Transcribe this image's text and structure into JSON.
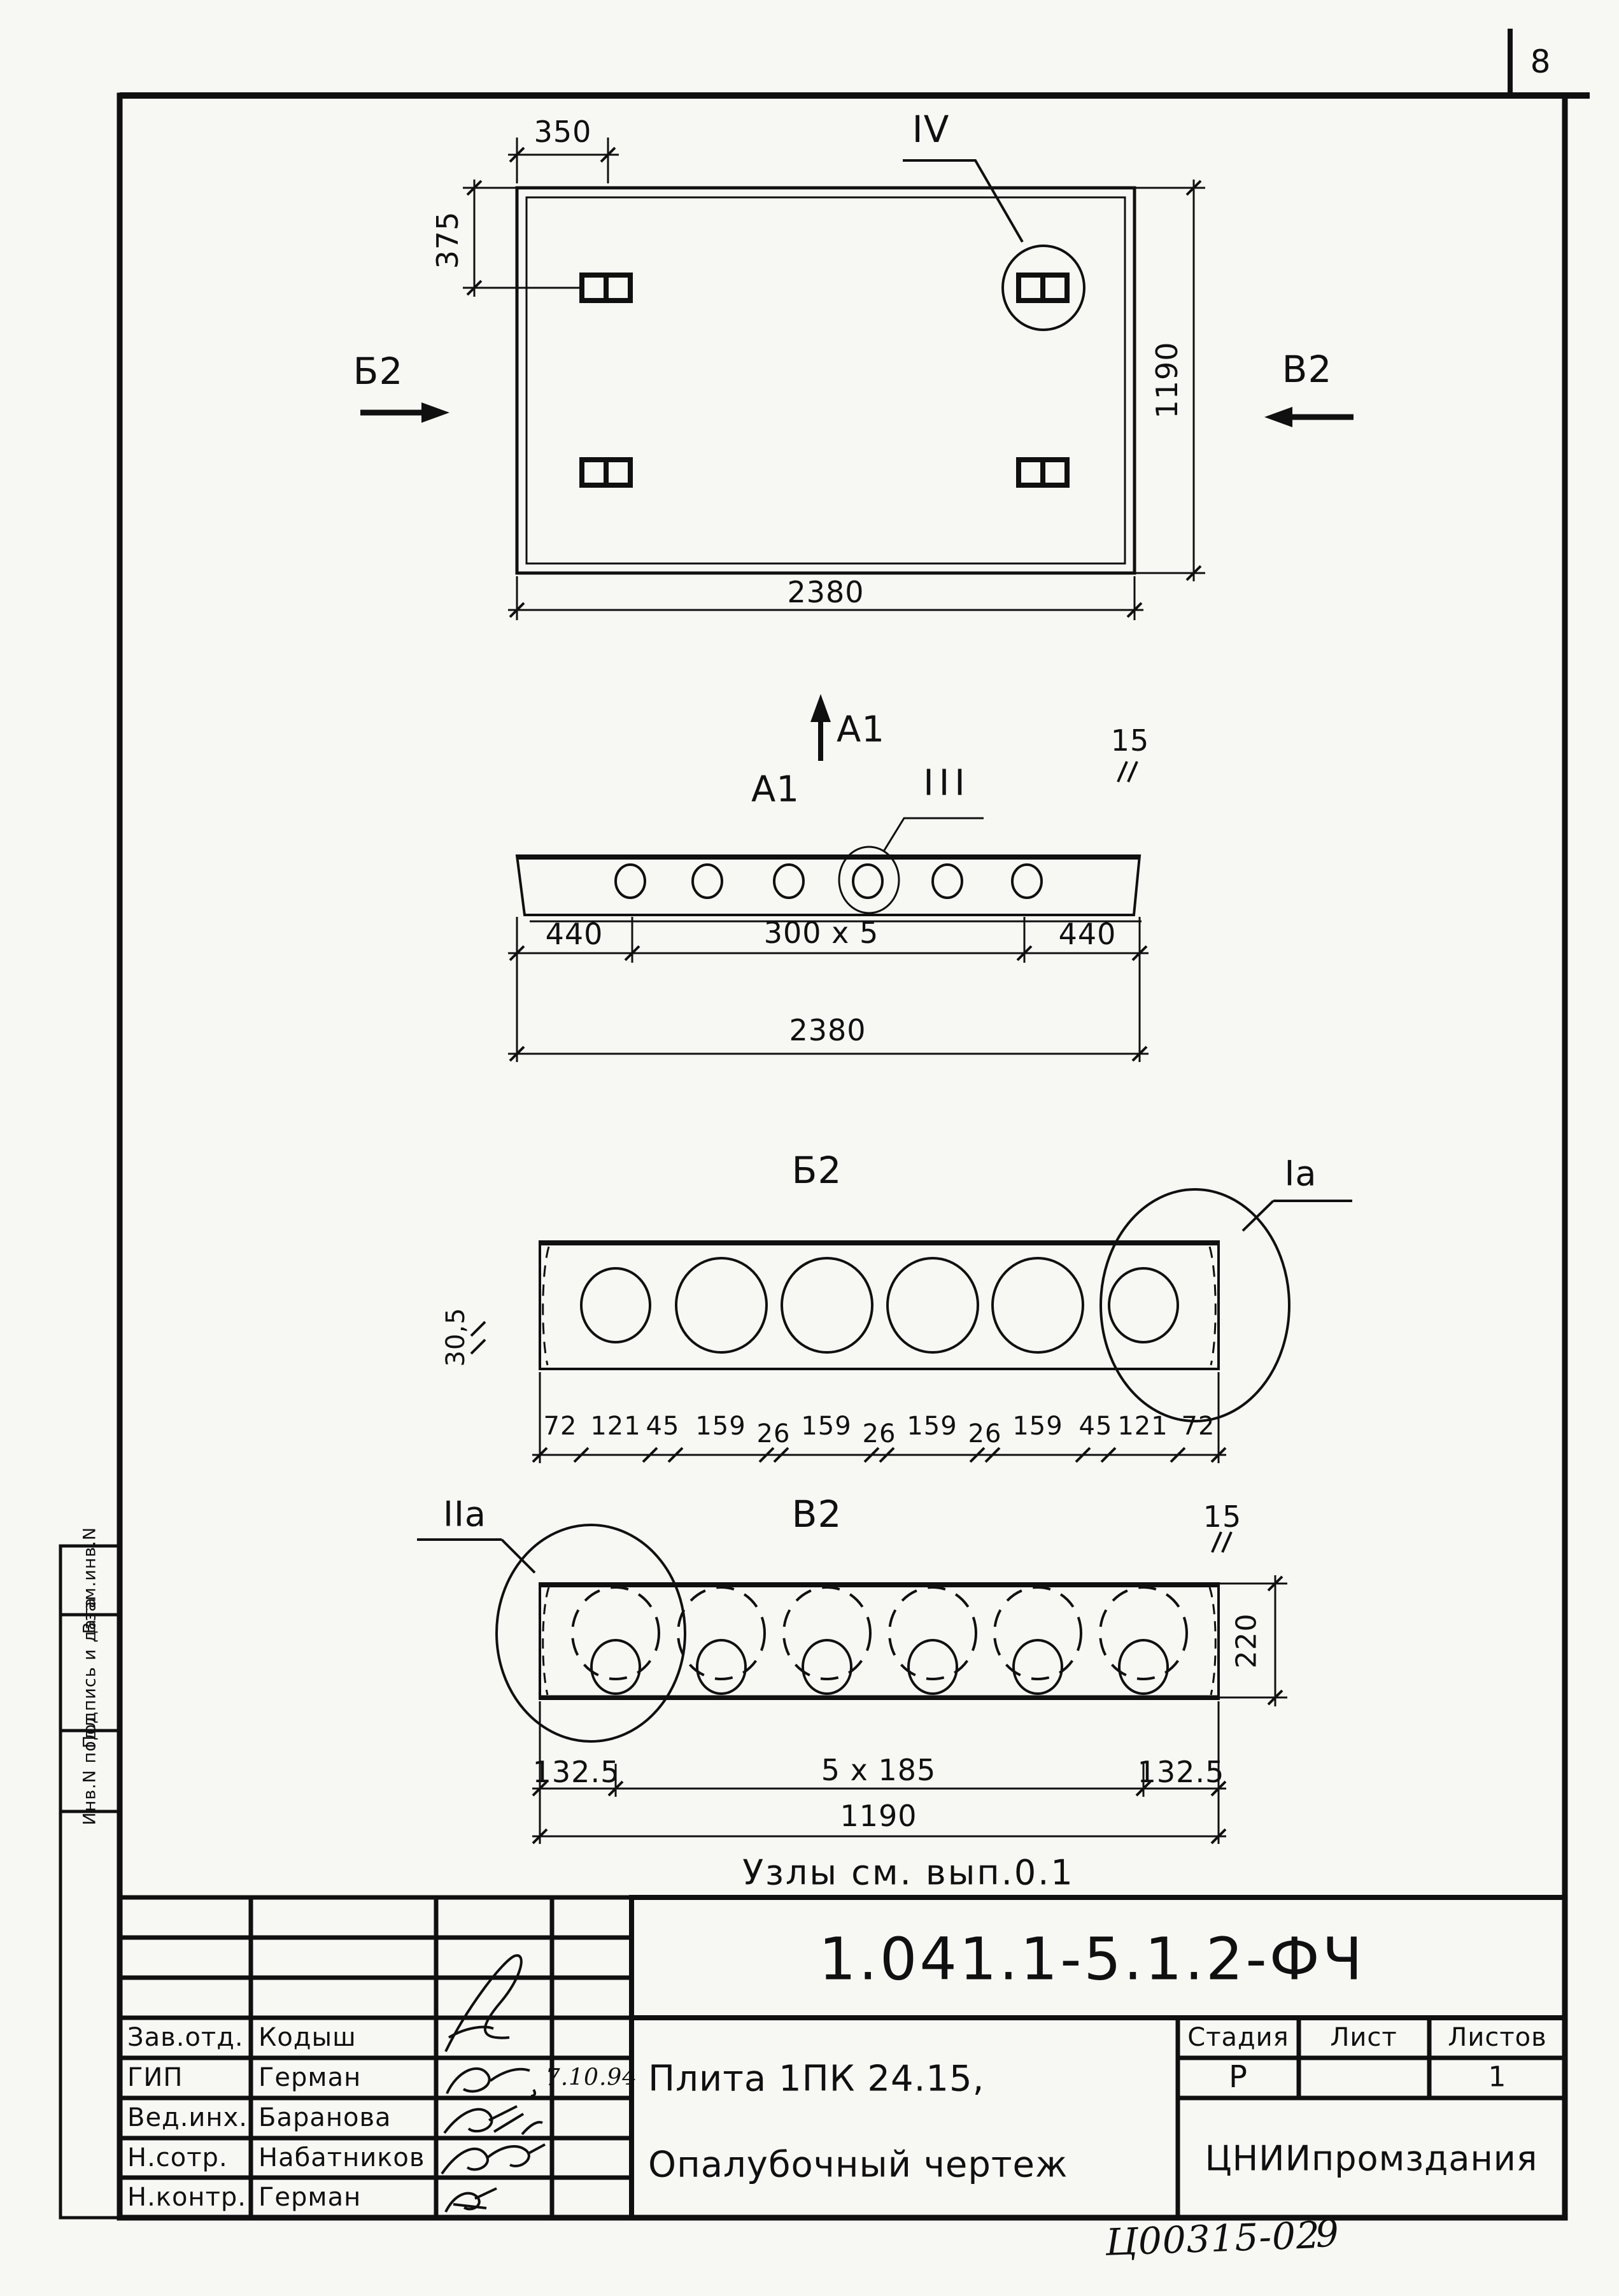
{
  "page_number": "8",
  "plan": {
    "label_detail": "IV",
    "label_section_left": "Б2",
    "label_section_right": "В2",
    "dim_top": "350",
    "dim_left": "375",
    "dim_right": "1190",
    "dim_bottom": "2380"
  },
  "section_a1": {
    "direction_label": "A1",
    "title": "A1",
    "detail_label": "III",
    "chamfer": "15",
    "dim_left": "440",
    "dim_mid": "300 x 5",
    "dim_right": "440",
    "dim_total": "2380"
  },
  "section_b2": {
    "title": "Б2",
    "detail_label": "Ia",
    "edge_dim": "30,5",
    "dims": [
      "72",
      "121",
      "45",
      "159",
      "26",
      "159",
      "26",
      "159",
      "26",
      "159",
      "45",
      "121",
      "72"
    ]
  },
  "section_v2": {
    "title": "В2",
    "detail_label": "IIa",
    "chamfer": "15",
    "height_dim": "220",
    "dim_left": "132.5",
    "dim_mid": "5 x 185",
    "dim_right": "132.5",
    "dim_total": "1190"
  },
  "note": "Узлы см. вып.0.1",
  "title_block": {
    "doc_number": "1.041.1-5.1.2-ФЧ",
    "product_line1": "Плита 1ПК 24.15,",
    "product_line2": "Опалубочный чертеж",
    "org": "ЦНИИпромздания",
    "stage_label": "Стадия",
    "sheet_label": "Лист",
    "sheets_label": "Листов",
    "stage": "Р",
    "sheet": "",
    "sheets": "1",
    "rows": [
      {
        "role": "Зав.отд.",
        "name": "Кодыш",
        "date": ""
      },
      {
        "role": "ГИП",
        "name": "Герман",
        "date": "7.10.94"
      },
      {
        "role": "Вед.инх.",
        "name": "Баранова",
        "date": ""
      },
      {
        "role": "Н.сотр.",
        "name": "Набатников",
        "date": ""
      },
      {
        "role": "Н.контр.",
        "name": "Герман",
        "date": ""
      }
    ]
  },
  "margin_column": {
    "top": "Взам.инв.N",
    "middle": "Подпись и дата",
    "bottom": "Инв.N подл"
  },
  "stamp": {
    "code": "Ц00315-02",
    "page": "9"
  }
}
